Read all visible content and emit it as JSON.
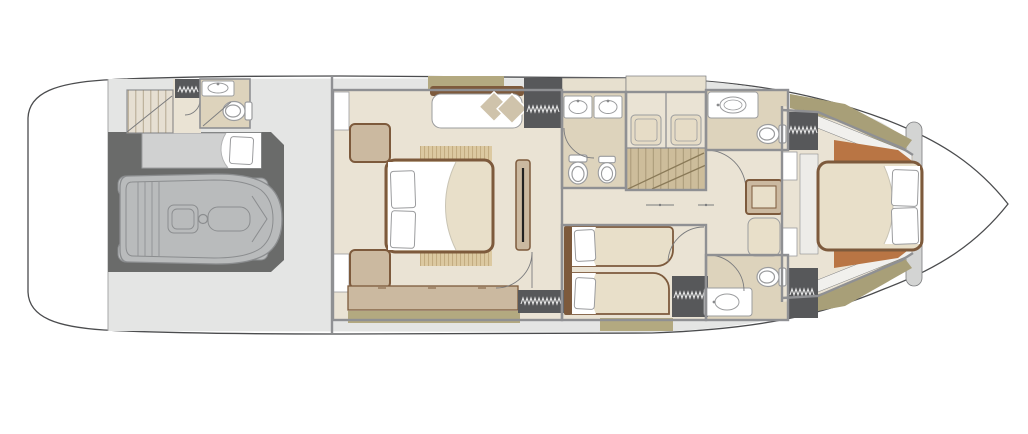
{
  "meta": {
    "label": "Motor yacht lower deck floor plan, top view"
  },
  "palette": {
    "bg": "#ffffff",
    "hull_stroke": "#4b4c4e",
    "deck": "#e4e5e4",
    "deck_dark": "#d3d4d3",
    "wall": "#8f9093",
    "thin_line": "#7b7c7e",
    "garage": "#6a6b6a",
    "tender": "#b9bbbc",
    "tender_line": "#8b8d8f",
    "floor": "#eae3d4",
    "floor_bath": "#ddd3bc",
    "cabinet": "#e7e0cf",
    "linen": "#e8dfc9",
    "wood": "#7d5a3c",
    "wood_light": "#cbb9a0",
    "rib_fill": "#dcc9a1",
    "rib_line": "#b89d72",
    "khaki": "#a89f78",
    "khaki_light": "#b3a980",
    "rust": "#b97544",
    "wardrobe": "#57585a",
    "hanger": "#e6e6e6",
    "white": "#ffffff",
    "fixture_stroke": "#9b9c9e",
    "stairs": "#cdbd9b",
    "stairs_line": "#8a7a58",
    "cushion": "#cfc3ab",
    "berth": "#d0d1d1",
    "sheet_line": "#c9c4b4",
    "ledge": "#f1f0ed"
  },
  "areas": [
    "swim-platform",
    "tender-garage",
    "tender",
    "crew-quarters",
    "crew-bathroom",
    "vip-cabin-amidships",
    "ensuite-bathroom-amidships",
    "shower-room",
    "main-staircase",
    "corridor",
    "twin-guest-cabin",
    "forward-bathroom-port",
    "forward-bathroom-starboard",
    "master-cabin-forward",
    "bow-stowage"
  ]
}
